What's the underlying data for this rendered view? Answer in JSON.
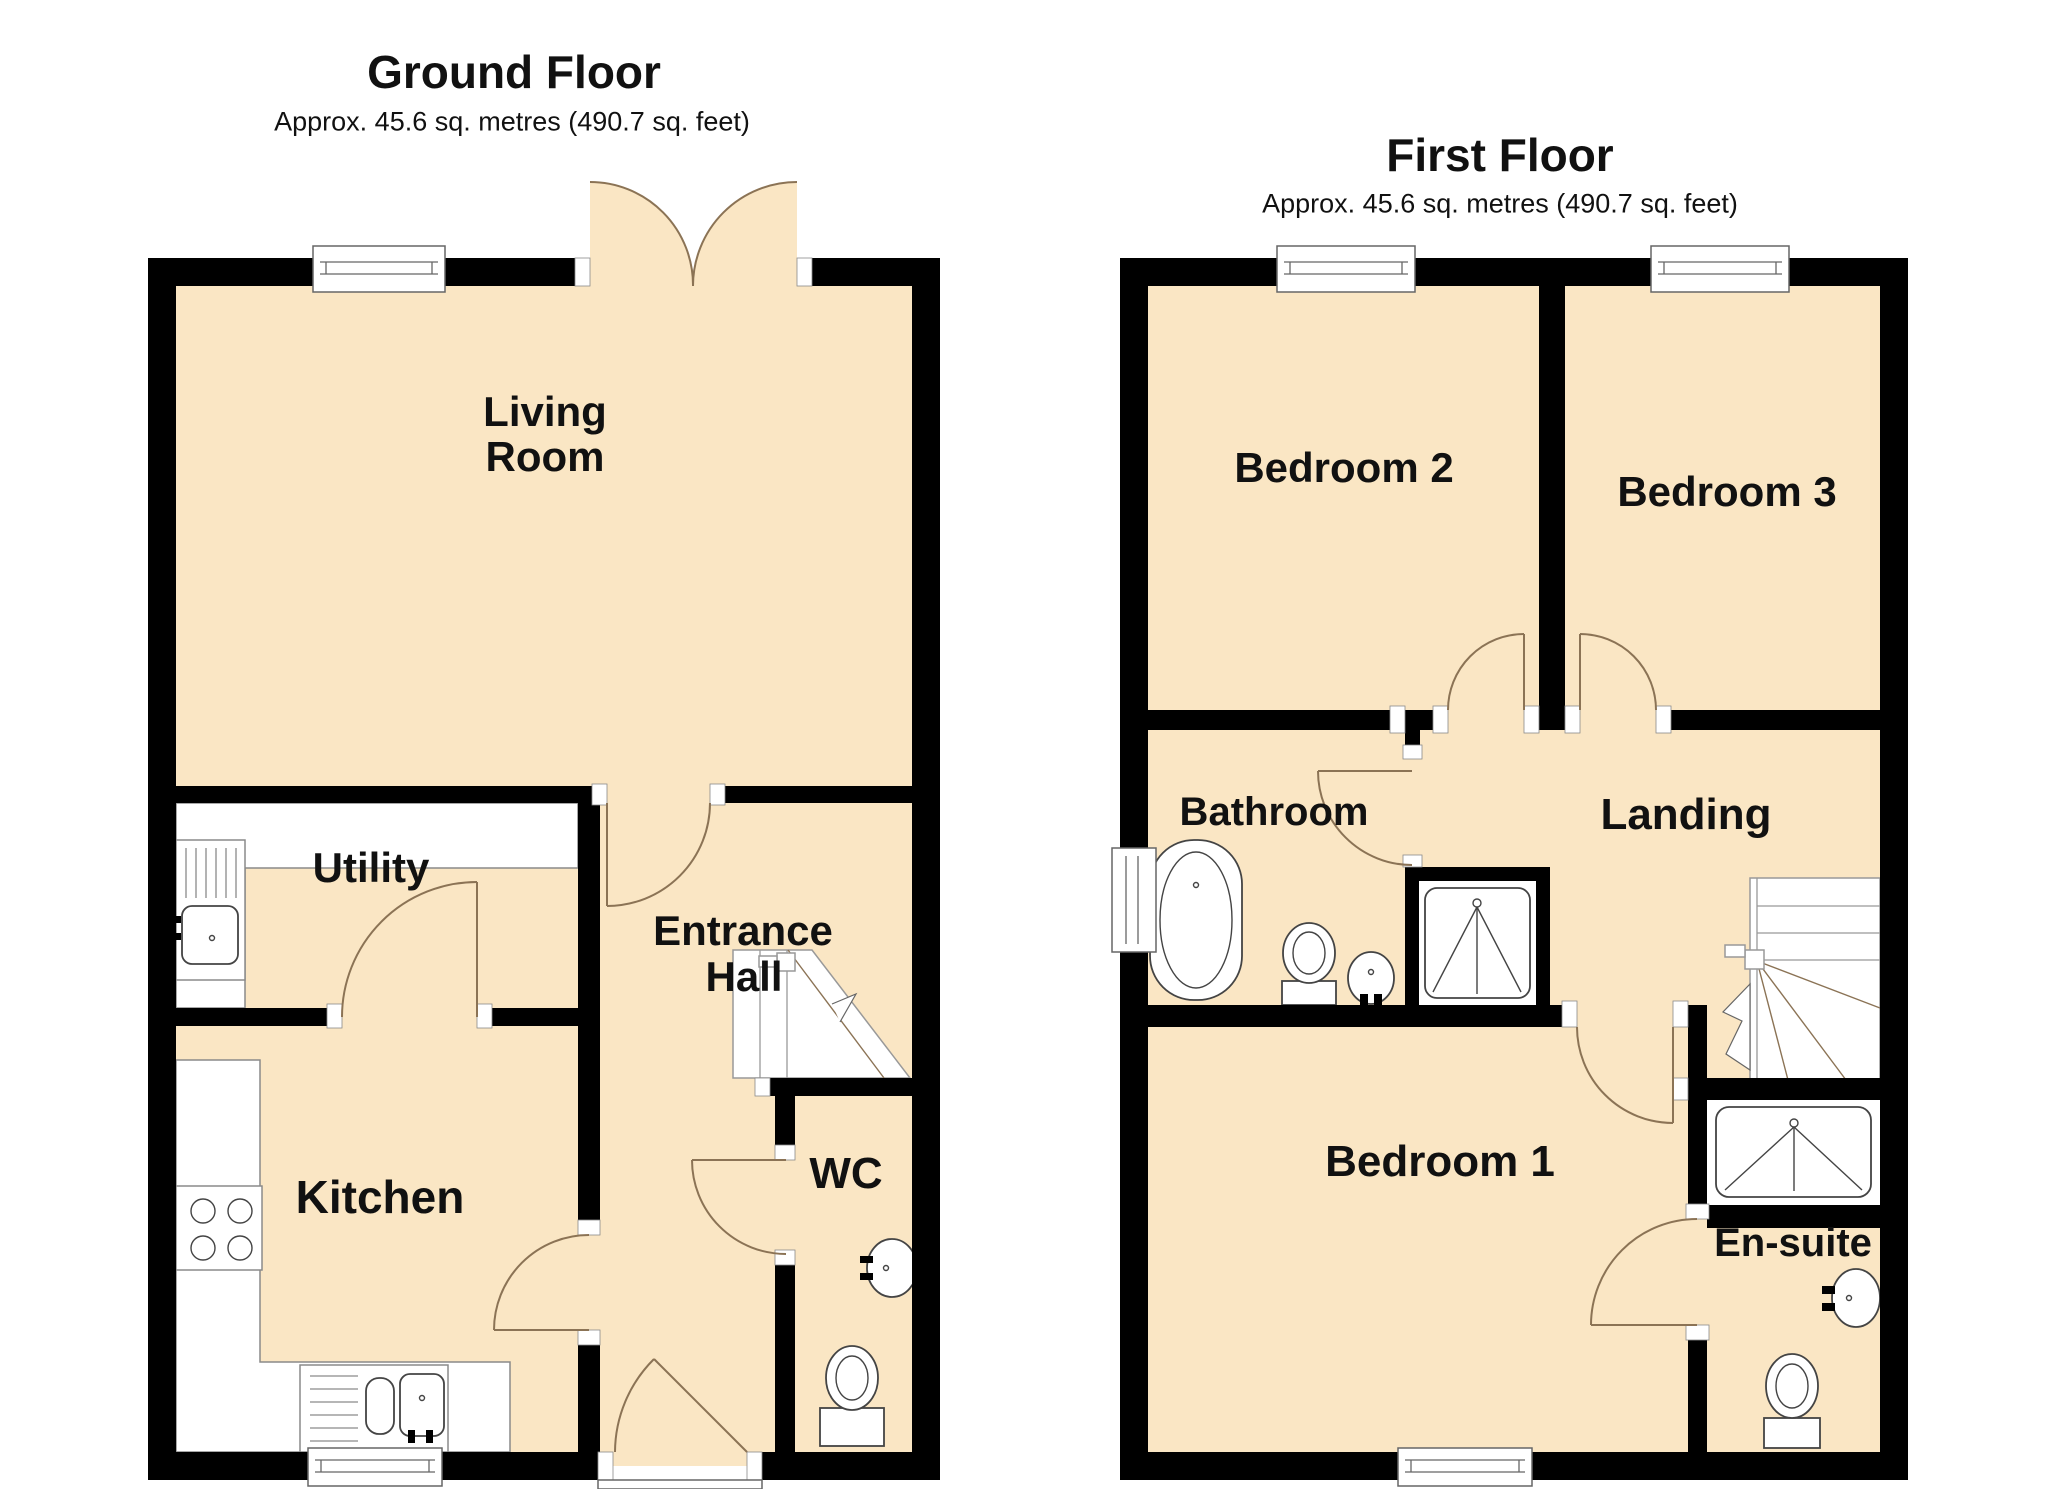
{
  "document_type": "floorplan",
  "colors": {
    "room_fill": "#FAE6C4",
    "wall": "#000000",
    "door_arc": "#8B7355",
    "fixture_line": "#444444",
    "counter_line": "#8a8a8a",
    "text": "#111111"
  },
  "ground_floor": {
    "title": "Ground Floor",
    "subtitle": "Approx. 45.6 sq. metres (490.7 sq. feet)",
    "rooms": {
      "living_room": {
        "line1": "Living",
        "line2": "Room"
      },
      "utility": {
        "label": "Utility"
      },
      "entrance_hall": {
        "line1": "Entrance",
        "line2": "Hall"
      },
      "kitchen": {
        "label": "Kitchen"
      },
      "wc": {
        "label": "WC"
      }
    },
    "features": [
      "french-doors",
      "stairs-up",
      "kitchen-sink",
      "utility-sink",
      "hob",
      "wc-toilet",
      "wc-basin",
      "front-door",
      "windows"
    ]
  },
  "first_floor": {
    "title": "First Floor",
    "subtitle": "Approx. 45.6 sq. metres (490.7 sq. feet)",
    "rooms": {
      "bedroom_2": {
        "label": "Bedroom 2"
      },
      "bedroom_3": {
        "label": "Bedroom 3"
      },
      "bathroom": {
        "label": "Bathroom"
      },
      "landing": {
        "label": "Landing"
      },
      "bedroom_1": {
        "label": "Bedroom 1"
      },
      "en_suite": {
        "label": "En-suite"
      }
    },
    "features": [
      "bath",
      "shower-cubicle",
      "bathroom-toilet",
      "bathroom-basin",
      "stairs-down",
      "ensuite-shower",
      "ensuite-basin",
      "ensuite-toilet",
      "windows"
    ]
  }
}
